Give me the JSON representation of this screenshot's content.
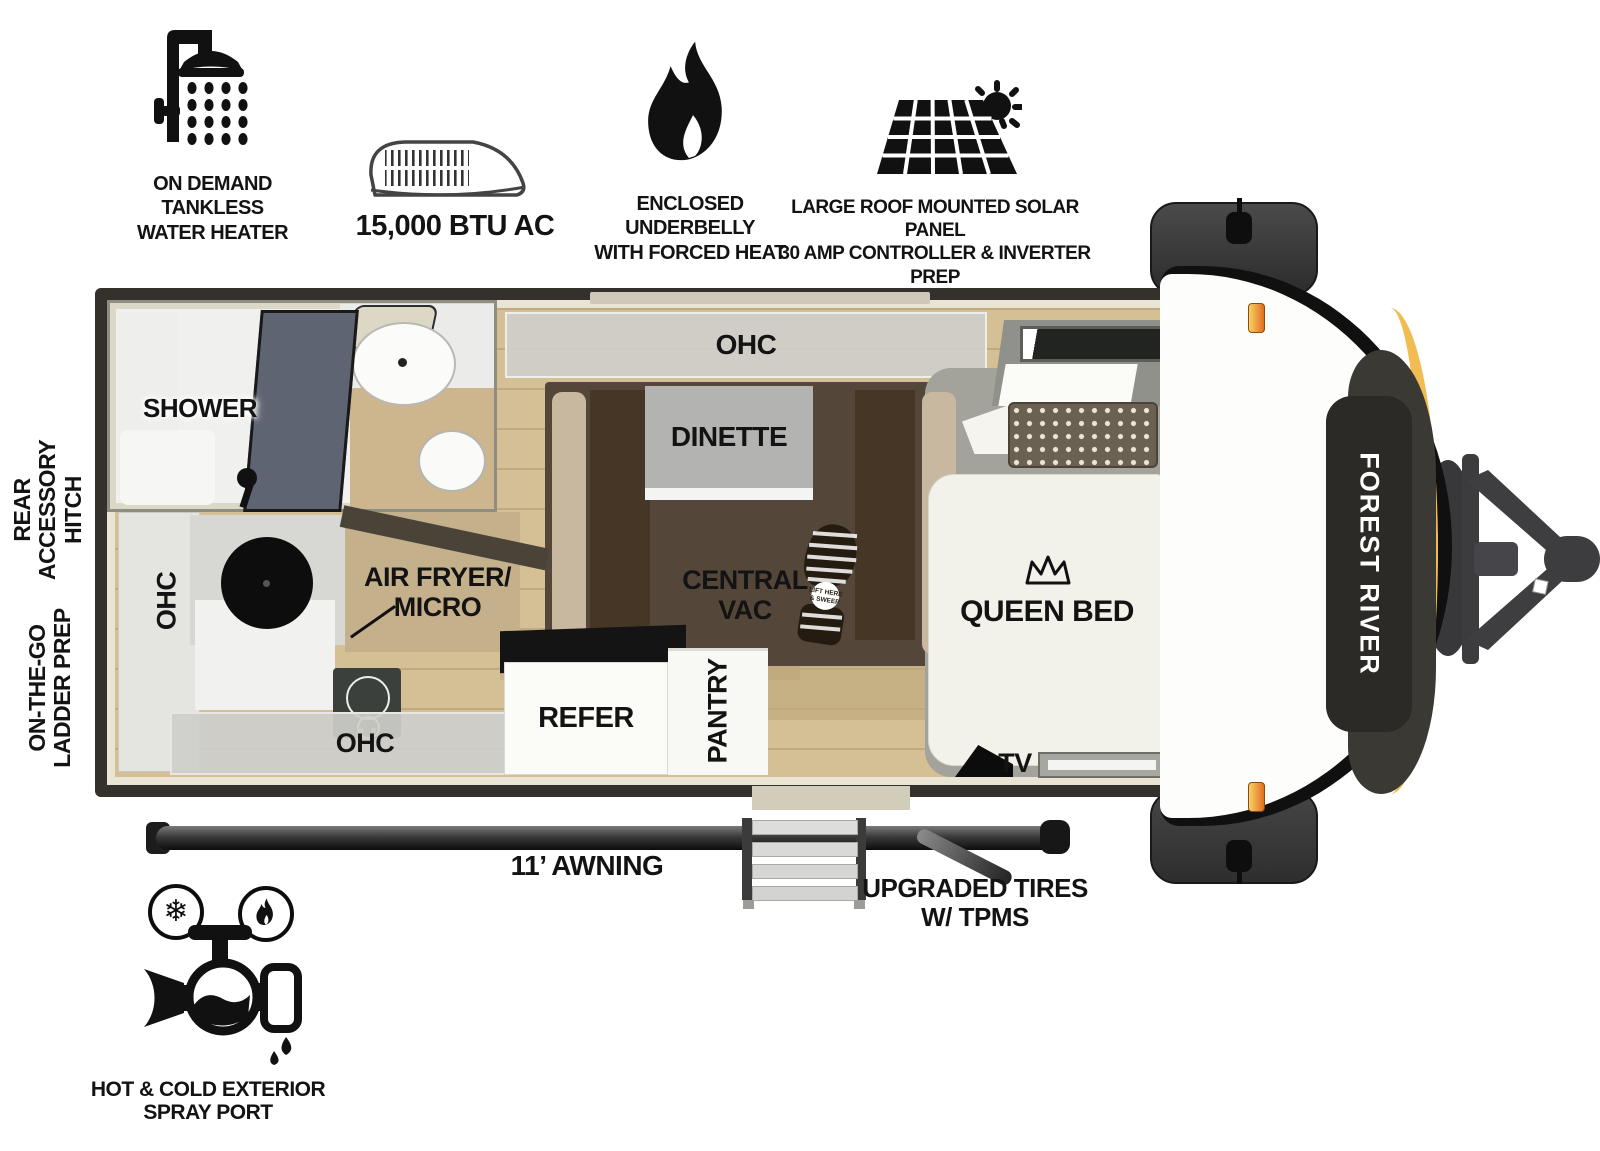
{
  "features": {
    "water_heater": {
      "icon": "shower-head-icon",
      "line1": "ON DEMAND",
      "line2": "TANKLESS",
      "line3": "WATER HEATER"
    },
    "ac": {
      "icon": "rooftop-ac-icon",
      "label": "15,000 BTU AC"
    },
    "underbelly": {
      "icon": "flame-icon",
      "line1": "ENCLOSED UNDERBELLY",
      "line2": "WITH FORCED HEAT"
    },
    "solar": {
      "icon": "solar-panel-sun-icon",
      "line1": "LARGE ROOF MOUNTED SOLAR PANEL",
      "line2": "30 AMP CONTROLLER & INVERTER PREP"
    }
  },
  "side_labels": {
    "rear_hitch": {
      "line1": "REAR",
      "line2": "ACCESSORY",
      "line3": "HITCH"
    },
    "ladder": {
      "line1": "ON-THE-GO",
      "line2": "LADDER PREP"
    }
  },
  "rooms": {
    "shower": "SHOWER",
    "dinette_ohc": "OHC",
    "dinette": "DINETTE",
    "kitchen_ohc_left": "OHC",
    "kitchen_ohc_bottom": "OHC",
    "air_fryer_line1": "AIR FRYER/",
    "air_fryer_line2": "MICRO",
    "central_vac_line1": "CENTRAL",
    "central_vac_line2": "VAC",
    "bootprint_line1": "LIFT HERE",
    "bootprint_line2": "& SWEEP",
    "refer": "REFER",
    "pantry": "PANTRY",
    "queen_bed": "QUEEN BED",
    "tv": "TV"
  },
  "exterior": {
    "brand": "FOREST RIVER",
    "awning": "11’ AWNING",
    "tires_line1": "UPGRADED TIRES",
    "tires_line2": "W/ TPMS"
  },
  "spray_port": {
    "icon": "hot-cold-spray-port-icon",
    "snowflake_glyph": "❄",
    "line1": "HOT & COLD EXTERIOR",
    "line2": "SPRAY PORT"
  },
  "colors": {
    "wall_dark": "#34312C",
    "floor_tan": "#D5C096",
    "accent_yellow": "#F1BD53",
    "marker_orange": "#E06F1F",
    "ink": "#111111"
  }
}
